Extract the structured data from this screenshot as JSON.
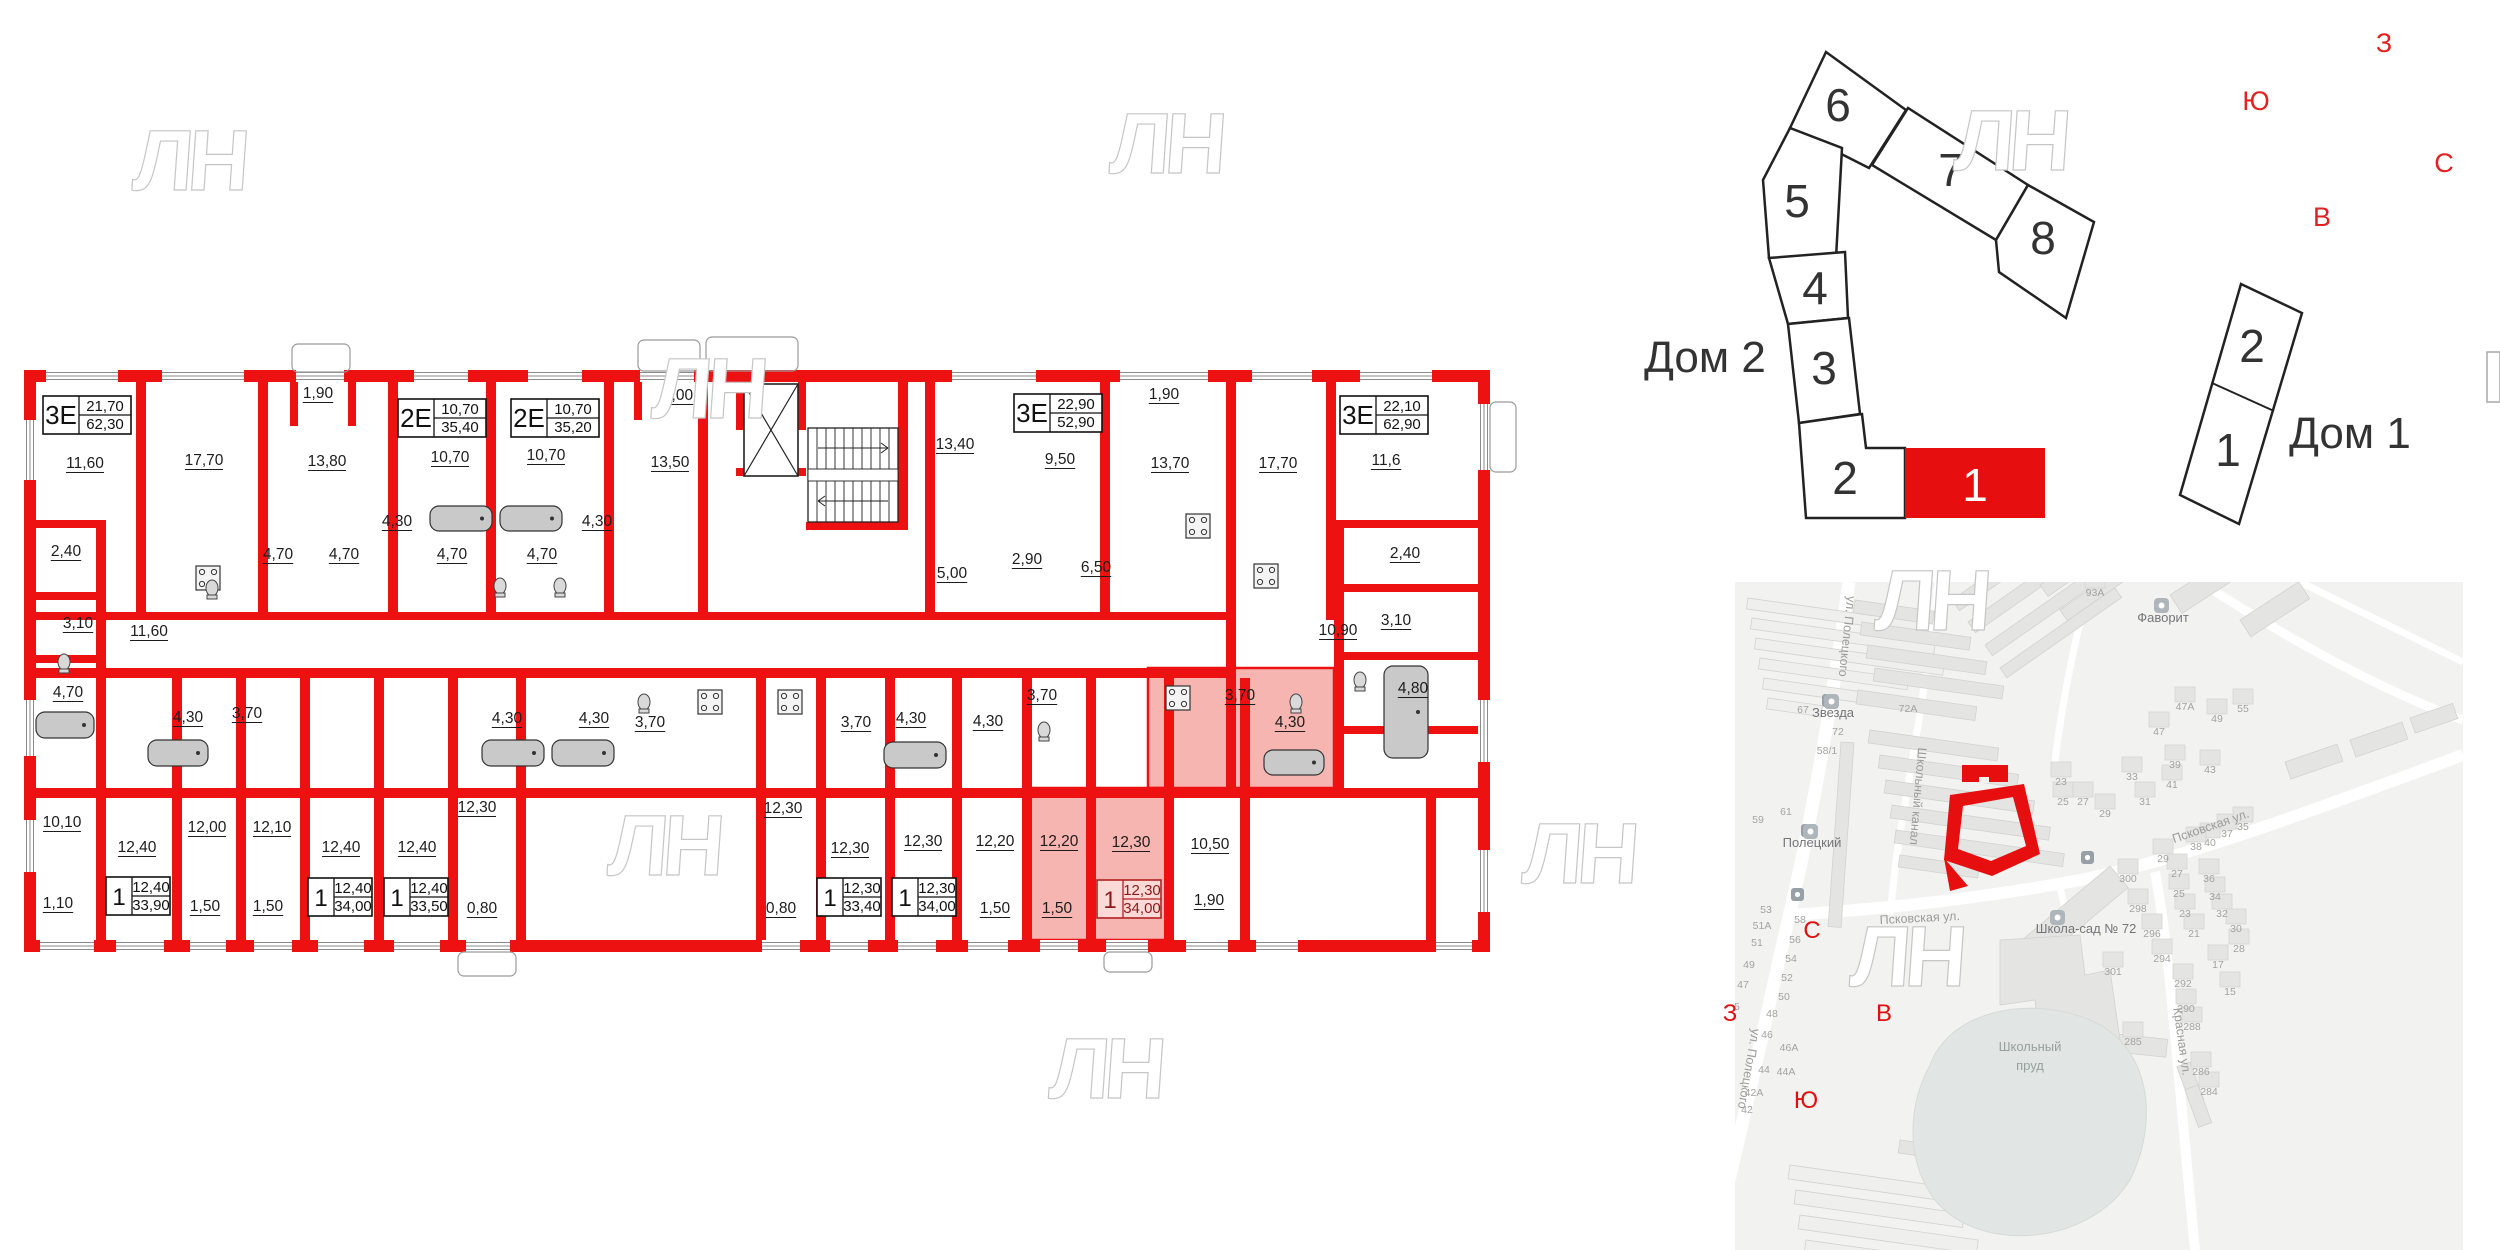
{
  "watermark_text": "ЛН",
  "floorplan": {
    "wall_color": "#ee1111",
    "highlight_color": "#f6b5b1",
    "apartments": [
      {
        "type": "3Е",
        "a1": "21,70",
        "a2": "62,30",
        "x": 43,
        "y": 396,
        "big": true,
        "hl": false
      },
      {
        "type": "2Е",
        "a1": "10,70",
        "a2": "35,40",
        "x": 398,
        "y": 399,
        "big": true,
        "hl": false
      },
      {
        "type": "2Е",
        "a1": "10,70",
        "a2": "35,20",
        "x": 511,
        "y": 399,
        "big": true,
        "hl": false
      },
      {
        "type": "3Е",
        "a1": "22,90",
        "a2": "52,90",
        "x": 1014,
        "y": 394,
        "big": true,
        "hl": false
      },
      {
        "type": "3Е",
        "a1": "22,10",
        "a2": "62,90",
        "x": 1340,
        "y": 396,
        "big": true,
        "hl": false
      },
      {
        "type": "1",
        "a1": "12,40",
        "a2": "33,90",
        "x": 106,
        "y": 877,
        "big": false,
        "hl": false
      },
      {
        "type": "1",
        "a1": "12,40",
        "a2": "34,00",
        "x": 308,
        "y": 878,
        "big": false,
        "hl": false
      },
      {
        "type": "1",
        "a1": "12,40",
        "a2": "33,50",
        "x": 384,
        "y": 878,
        "big": false,
        "hl": false
      },
      {
        "type": "1",
        "a1": "12,30",
        "a2": "33,40",
        "x": 817,
        "y": 878,
        "big": false,
        "hl": false
      },
      {
        "type": "1",
        "a1": "12,30",
        "a2": "34,00",
        "x": 892,
        "y": 878,
        "big": false,
        "hl": false
      },
      {
        "type": "1",
        "a1": "12,30",
        "a2": "34,00",
        "x": 1097,
        "y": 880,
        "big": false,
        "hl": true
      }
    ],
    "rooms": [
      {
        "t": "11,60",
        "x": 85,
        "y": 468
      },
      {
        "t": "17,70",
        "x": 204,
        "y": 465
      },
      {
        "t": "1,90",
        "x": 318,
        "y": 398
      },
      {
        "t": "13,80",
        "x": 327,
        "y": 466
      },
      {
        "t": "10,70",
        "x": 450,
        "y": 462
      },
      {
        "t": "10,70",
        "x": 546,
        "y": 460
      },
      {
        "t": "2,00",
        "x": 678,
        "y": 400
      },
      {
        "t": "13,50",
        "x": 670,
        "y": 467
      },
      {
        "t": "13,40",
        "x": 955,
        "y": 449
      },
      {
        "t": "9,50",
        "x": 1060,
        "y": 464
      },
      {
        "t": "1,90",
        "x": 1164,
        "y": 399
      },
      {
        "t": "13,70",
        "x": 1170,
        "y": 468
      },
      {
        "t": "17,70",
        "x": 1278,
        "y": 468
      },
      {
        "t": "11,6",
        "x": 1386,
        "y": 465
      },
      {
        "t": "2,40",
        "x": 66,
        "y": 556
      },
      {
        "t": "3,10",
        "x": 78,
        "y": 628
      },
      {
        "t": "4,70",
        "x": 68,
        "y": 697
      },
      {
        "t": "4,70",
        "x": 278,
        "y": 559
      },
      {
        "t": "4,70",
        "x": 344,
        "y": 559
      },
      {
        "t": "4,30",
        "x": 397,
        "y": 526
      },
      {
        "t": "4,70",
        "x": 452,
        "y": 559
      },
      {
        "t": "4,70",
        "x": 542,
        "y": 559
      },
      {
        "t": "4,30",
        "x": 597,
        "y": 526
      },
      {
        "t": "2,90",
        "x": 1027,
        "y": 564
      },
      {
        "t": "5,00",
        "x": 952,
        "y": 578
      },
      {
        "t": "6,50",
        "x": 1096,
        "y": 572
      },
      {
        "t": "2,40",
        "x": 1405,
        "y": 558
      },
      {
        "t": "3,10",
        "x": 1396,
        "y": 625
      },
      {
        "t": "10,90",
        "x": 1338,
        "y": 635
      },
      {
        "t": "4,80",
        "x": 1413,
        "y": 693
      },
      {
        "t": "11,60",
        "x": 149,
        "y": 636
      },
      {
        "t": "4,30",
        "x": 188,
        "y": 722
      },
      {
        "t": "3,70",
        "x": 247,
        "y": 718
      },
      {
        "t": "4,30",
        "x": 507,
        "y": 723
      },
      {
        "t": "4,30",
        "x": 594,
        "y": 723
      },
      {
        "t": "3,70",
        "x": 650,
        "y": 727
      },
      {
        "t": "3,70",
        "x": 856,
        "y": 727
      },
      {
        "t": "4,30",
        "x": 911,
        "y": 723
      },
      {
        "t": "3,70",
        "x": 1042,
        "y": 700
      },
      {
        "t": "4,30",
        "x": 988,
        "y": 726
      },
      {
        "t": "3,70",
        "x": 1240,
        "y": 700,
        "p": true
      },
      {
        "t": "4,30",
        "x": 1290,
        "y": 727,
        "p": true
      },
      {
        "t": "10,10",
        "x": 62,
        "y": 827
      },
      {
        "t": "12,40",
        "x": 137,
        "y": 852
      },
      {
        "t": "12,00",
        "x": 207,
        "y": 832
      },
      {
        "t": "12,10",
        "x": 272,
        "y": 832
      },
      {
        "t": "12,40",
        "x": 341,
        "y": 852
      },
      {
        "t": "12,40",
        "x": 417,
        "y": 852
      },
      {
        "t": "12,30",
        "x": 477,
        "y": 812
      },
      {
        "t": "12,30",
        "x": 783,
        "y": 813
      },
      {
        "t": "12,30",
        "x": 850,
        "y": 853
      },
      {
        "t": "12,30",
        "x": 923,
        "y": 846
      },
      {
        "t": "12,20",
        "x": 995,
        "y": 846
      },
      {
        "t": "12,20",
        "x": 1059,
        "y": 846,
        "p": true
      },
      {
        "t": "12,30",
        "x": 1131,
        "y": 847,
        "p": true
      },
      {
        "t": "10,50",
        "x": 1210,
        "y": 849
      },
      {
        "t": "1,10",
        "x": 58,
        "y": 908
      },
      {
        "t": "1,50",
        "x": 205,
        "y": 911
      },
      {
        "t": "1,50",
        "x": 268,
        "y": 911
      },
      {
        "t": "0,80",
        "x": 482,
        "y": 913
      },
      {
        "t": "0,80",
        "x": 781,
        "y": 913
      },
      {
        "t": "1,50",
        "x": 995,
        "y": 913
      },
      {
        "t": "1,50",
        "x": 1057,
        "y": 913,
        "p": true
      },
      {
        "t": "1,90",
        "x": 1209,
        "y": 905
      }
    ]
  },
  "scheme": {
    "dom2_label": "Дом 2",
    "dom1_label": "Дом 1",
    "dom2_blocks": [
      {
        "n": "6"
      },
      {
        "n": "7"
      },
      {
        "n": "8"
      },
      {
        "n": "5"
      },
      {
        "n": "4"
      },
      {
        "n": "3"
      },
      {
        "n": "2"
      },
      {
        "n": "1",
        "red": true
      }
    ],
    "dom1_blocks": [
      {
        "n": "2"
      },
      {
        "n": "1"
      }
    ]
  },
  "compass_top": {
    "up": "З",
    "left": "Ю",
    "right": "С",
    "down": "В"
  },
  "compass_map": {
    "up": "С",
    "left": "З",
    "right": "В",
    "down": "Ю"
  },
  "map": {
    "streets": [
      {
        "name": "ул. Полецкого",
        "x": 1843,
        "y": 636,
        "rot": 96
      },
      {
        "name": "Школьный канал",
        "x": 1914,
        "y": 796,
        "rot": 95
      },
      {
        "name": "Псковская ул.",
        "x": 1920,
        "y": 922,
        "rot": -3
      },
      {
        "name": "Псковская ул.",
        "x": 2212,
        "y": 830,
        "rot": -19
      },
      {
        "name": "Красная ул.",
        "x": 2178,
        "y": 1042,
        "rot": 82
      },
      {
        "name": "ул. Полецкого",
        "x": 1745,
        "y": 1068,
        "rot": 100
      }
    ],
    "pois": [
      {
        "name": "Звезда",
        "x": 1833,
        "y": 717,
        "ix": 1824,
        "iy": 694
      },
      {
        "name": "Полецкий",
        "x": 1812,
        "y": 847,
        "ix": 1803,
        "iy": 824
      },
      {
        "name": "Фаворит",
        "x": 2163,
        "y": 622,
        "ix": 2154,
        "iy": 598
      },
      {
        "name": "Школа-сад № 72",
        "x": 2086,
        "y": 933,
        "ix": 2050,
        "iy": 910
      }
    ],
    "pond_label_1": "Школьный",
    "pond_label_2": "пруд",
    "house_numbers": [
      {
        "t": "67",
        "x": 1803,
        "y": 713
      },
      {
        "t": "72А",
        "x": 1908,
        "y": 712
      },
      {
        "t": "72",
        "x": 1838,
        "y": 735
      },
      {
        "t": "58/1",
        "x": 1827,
        "y": 754
      },
      {
        "t": "59",
        "x": 1758,
        "y": 823
      },
      {
        "t": "61",
        "x": 1786,
        "y": 815
      },
      {
        "t": "53",
        "x": 1766,
        "y": 913
      },
      {
        "t": "51А",
        "x": 1762,
        "y": 929
      },
      {
        "t": "51",
        "x": 1757,
        "y": 946
      },
      {
        "t": "58",
        "x": 1800,
        "y": 923
      },
      {
        "t": "56",
        "x": 1795,
        "y": 943
      },
      {
        "t": "54",
        "x": 1791,
        "y": 962
      },
      {
        "t": "52",
        "x": 1787,
        "y": 981
      },
      {
        "t": "50",
        "x": 1784,
        "y": 1000
      },
      {
        "t": "49",
        "x": 1749,
        "y": 968
      },
      {
        "t": "47",
        "x": 1743,
        "y": 988
      },
      {
        "t": "48",
        "x": 1772,
        "y": 1017
      },
      {
        "t": "46",
        "x": 1767,
        "y": 1038
      },
      {
        "t": "46А",
        "x": 1789,
        "y": 1051
      },
      {
        "t": "44",
        "x": 1764,
        "y": 1073
      },
      {
        "t": "44А",
        "x": 1786,
        "y": 1075
      },
      {
        "t": "42А",
        "x": 1754,
        "y": 1096
      },
      {
        "t": "42",
        "x": 1747,
        "y": 1113
      },
      {
        "t": "45",
        "x": 1734,
        "y": 1010
      },
      {
        "t": "93А",
        "x": 2095,
        "y": 596
      },
      {
        "t": "47А",
        "x": 2185,
        "y": 710
      },
      {
        "t": "49",
        "x": 2217,
        "y": 722
      },
      {
        "t": "55",
        "x": 2243,
        "y": 712
      },
      {
        "t": "47",
        "x": 2159,
        "y": 735
      },
      {
        "t": "39",
        "x": 2175,
        "y": 768
      },
      {
        "t": "41",
        "x": 2172,
        "y": 788
      },
      {
        "t": "43",
        "x": 2210,
        "y": 773
      },
      {
        "t": "33",
        "x": 2132,
        "y": 780
      },
      {
        "t": "31",
        "x": 2145,
        "y": 805
      },
      {
        "t": "23",
        "x": 2061,
        "y": 785
      },
      {
        "t": "25",
        "x": 2063,
        "y": 805
      },
      {
        "t": "27",
        "x": 2083,
        "y": 805
      },
      {
        "t": "29",
        "x": 2105,
        "y": 817
      },
      {
        "t": "37",
        "x": 2227,
        "y": 837
      },
      {
        "t": "35",
        "x": 2243,
        "y": 830
      },
      {
        "t": "40",
        "x": 2210,
        "y": 846
      },
      {
        "t": "38",
        "x": 2196,
        "y": 850
      },
      {
        "t": "29",
        "x": 2163,
        "y": 862
      },
      {
        "t": "27",
        "x": 2177,
        "y": 877
      },
      {
        "t": "36",
        "x": 2209,
        "y": 882
      },
      {
        "t": "25",
        "x": 2179,
        "y": 897
      },
      {
        "t": "34",
        "x": 2215,
        "y": 900
      },
      {
        "t": "23",
        "x": 2185,
        "y": 917
      },
      {
        "t": "32",
        "x": 2222,
        "y": 917
      },
      {
        "t": "21",
        "x": 2194,
        "y": 937
      },
      {
        "t": "30",
        "x": 2236,
        "y": 932
      },
      {
        "t": "28",
        "x": 2239,
        "y": 952
      },
      {
        "t": "300",
        "x": 2128,
        "y": 882
      },
      {
        "t": "298",
        "x": 2138,
        "y": 912
      },
      {
        "t": "296",
        "x": 2152,
        "y": 937
      },
      {
        "t": "294",
        "x": 2162,
        "y": 962
      },
      {
        "t": "301",
        "x": 2113,
        "y": 975
      },
      {
        "t": "17",
        "x": 2218,
        "y": 968
      },
      {
        "t": "15",
        "x": 2230,
        "y": 995
      },
      {
        "t": "292",
        "x": 2183,
        "y": 987
      },
      {
        "t": "290",
        "x": 2186,
        "y": 1012
      },
      {
        "t": "288",
        "x": 2192,
        "y": 1030
      },
      {
        "t": "285",
        "x": 2133,
        "y": 1045
      },
      {
        "t": "286",
        "x": 2201,
        "y": 1075
      },
      {
        "t": "284",
        "x": 2209,
        "y": 1095
      }
    ]
  }
}
